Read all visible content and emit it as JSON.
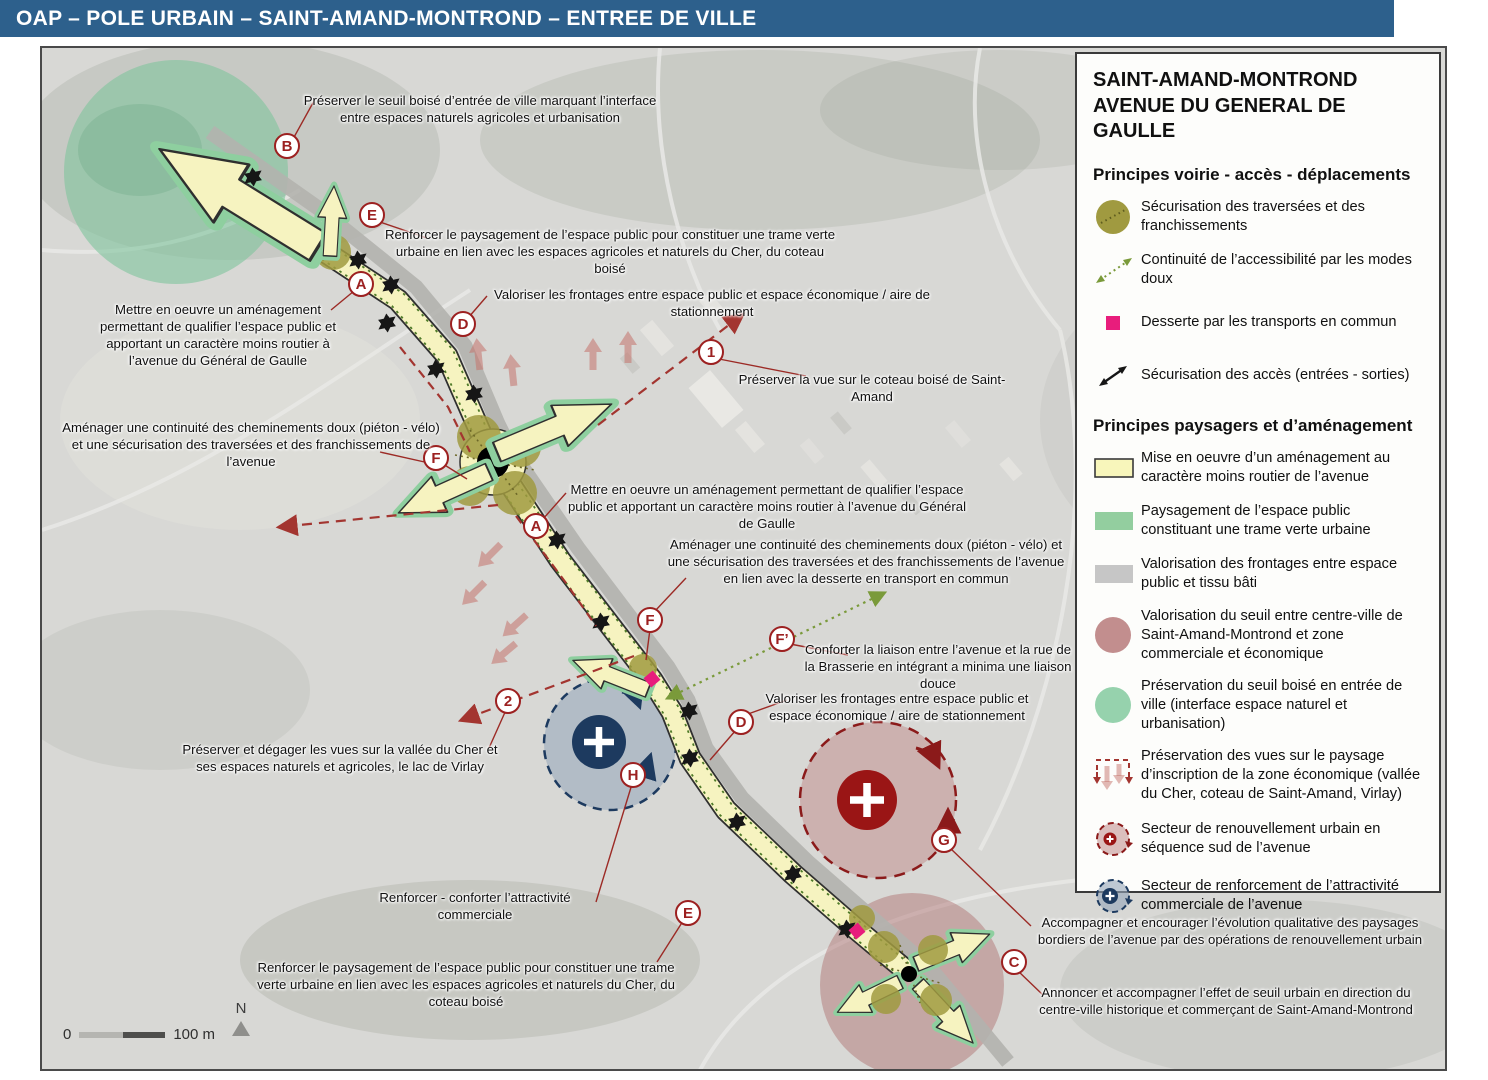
{
  "title_bar": {
    "text": "OAP – POLE URBAIN – SAINT-AMAND-MONTROND – ENTREE DE VILLE"
  },
  "legend": {
    "title_line1": "SAINT-AMAND-MONTROND",
    "title_line2": "AVENUE DU GENERAL DE GAULLE",
    "sections": [
      {
        "heading": "Principes voirie - accès - déplacements",
        "items": [
          {
            "icon": "olive-circle-dotted-icon",
            "label": "Sécurisation des traversées et des franchissements"
          },
          {
            "icon": "dotted-green-arrow-icon",
            "label": "Continuité de l’accessibilité par les modes doux"
          },
          {
            "icon": "magenta-square-icon",
            "label": "Desserte par les transports en commun"
          },
          {
            "icon": "black-double-arrow-icon",
            "label": "Sécurisation des accès (entrées - sorties)"
          }
        ]
      },
      {
        "heading": "Principes paysagers et d’aménagement",
        "items": [
          {
            "icon": "yellow-swatch-icon",
            "label": "Mise en oeuvre d’un aménagement au caractère moins routier de l’avenue"
          },
          {
            "icon": "green-swatch-icon",
            "label": "Paysagement de l’espace public constituant une trame verte urbaine"
          },
          {
            "icon": "gray-swatch-icon",
            "label": "Valorisation des frontages entre espace public et tissu bâti"
          },
          {
            "icon": "rose-circle-icon",
            "label": "Valorisation du seuil entre centre-ville de Saint-Amand-Montrond et zone commerciale et économique"
          },
          {
            "icon": "green-circle-icon",
            "label": "Préservation du seuil boisé en entrée de ville (interface espace naturel et urbanisation)"
          },
          {
            "icon": "red-dashed-views-icon",
            "label": "Préservation des vues sur le paysage d’inscription de la zone économique (vallée du Cher, coteau de Saint-Amand, Virlay)"
          },
          {
            "icon": "red-dashed-sector-icon",
            "label": "Secteur de renouvellement urbain en séquence sud de l’avenue"
          },
          {
            "icon": "blue-dashed-sector-icon",
            "label": "Secteur de renforcement de l’attractivité commerciale de l’avenue"
          }
        ]
      }
    ]
  },
  "map": {
    "markers": [
      {
        "label": "B",
        "x": 287,
        "y": 146
      },
      {
        "label": "E",
        "x": 372,
        "y": 215
      },
      {
        "label": "A",
        "x": 361,
        "y": 284
      },
      {
        "label": "D",
        "x": 463,
        "y": 324
      },
      {
        "label": "1",
        "x": 711,
        "y": 352
      },
      {
        "label": "F",
        "x": 436,
        "y": 458
      },
      {
        "label": "A",
        "x": 536,
        "y": 526
      },
      {
        "label": "F",
        "x": 650,
        "y": 620
      },
      {
        "label": "F’",
        "x": 782,
        "y": 639
      },
      {
        "label": "D",
        "x": 741,
        "y": 722
      },
      {
        "label": "2",
        "x": 508,
        "y": 701
      },
      {
        "label": "H",
        "x": 633,
        "y": 775
      },
      {
        "label": "G",
        "x": 944,
        "y": 840
      },
      {
        "label": "E",
        "x": 688,
        "y": 913
      },
      {
        "label": "C",
        "x": 1014,
        "y": 962
      }
    ],
    "annotations": [
      {
        "id": "seuil-boise-haut",
        "cx": 480,
        "y": 92,
        "w": 380,
        "text": "Préserver le seuil boisé d’entrée de ville marquant l’interface entre espaces naturels agricoles et urbanisation"
      },
      {
        "id": "paysagement-haut",
        "cx": 610,
        "y": 226,
        "w": 455,
        "text": "Renforcer le paysagement de l’espace public pour constituer une trame verte urbaine en lien avec les espaces agricoles et naturels du Cher, du coteau boisé"
      },
      {
        "id": "frontages-haut",
        "cx": 712,
        "y": 286,
        "w": 475,
        "text": "Valoriser les frontages entre espace public et espace économique / aire de stationnement"
      },
      {
        "id": "amenagement-gauche",
        "cx": 218,
        "y": 301,
        "w": 255,
        "text": "Mettre en oeuvre un aménagement permettant de qualifier l’espace public et apportant un caractère moins routier à l’avenue du Général de Gaulle"
      },
      {
        "id": "vue-coteau",
        "cx": 872,
        "y": 371,
        "w": 290,
        "text": "Préserver la vue sur le coteau boisé de Saint-Amand"
      },
      {
        "id": "cheminements-gauche",
        "cx": 251,
        "y": 419,
        "w": 385,
        "text": "Aménager une continuité des cheminements doux (piéton - vélo) et une sécurisation des traversées et des franchissements de l’avenue"
      },
      {
        "id": "amenagement-centre",
        "cx": 767,
        "y": 481,
        "w": 405,
        "text": "Mettre en oeuvre un aménagement permettant de qualifier l’espace public et apportant un caractère moins routier à l’avenue du Général de Gaulle"
      },
      {
        "id": "cheminements-centre",
        "cx": 866,
        "y": 536,
        "w": 400,
        "text": "Aménager une continuité des cheminements doux (piéton - vélo) et une sécurisation des traversées et des franchissements de l’avenue en lien avec la desserte en transport en commun"
      },
      {
        "id": "liaison-brasserie",
        "cx": 938,
        "y": 641,
        "w": 275,
        "text": "Conforter la liaison entre l’avenue et la rue de la Brasserie en intégrant a minima une liaison douce"
      },
      {
        "id": "frontages-centre",
        "cx": 897,
        "y": 690,
        "w": 295,
        "text": "Valoriser les frontages entre espace public et espace économique / aire de stationnement"
      },
      {
        "id": "vues-vallee",
        "cx": 340,
        "y": 741,
        "w": 325,
        "text": "Préserver et dégager les vues sur la vallée du Cher et ses espaces naturels et agricoles, le lac de Virlay"
      },
      {
        "id": "attractivite",
        "cx": 475,
        "y": 889,
        "w": 255,
        "text": "Renforcer - conforter l’attractivité commerciale"
      },
      {
        "id": "paysagement-bas",
        "cx": 466,
        "y": 959,
        "w": 445,
        "text": "Renforcer le paysagement de l’espace public pour constituer une trame verte urbaine en lien avec les espaces agricoles et naturels du Cher, du coteau boisé"
      },
      {
        "id": "renouvellement",
        "cx": 1230,
        "y": 914,
        "w": 400,
        "text": "Accompagner et encourager l’évolution qualitative des paysages bordiers de l’avenue par des opérations de renouvellement urbain"
      },
      {
        "id": "seuil-urbain",
        "cx": 1226,
        "y": 984,
        "w": 395,
        "text": "Annoncer et accompagner l’effet de seuil urbain en direction du centre-ville historique et commerçant de Saint-Amand-Montrond"
      }
    ],
    "scale_bar": {
      "start_label": "0",
      "end_label": "100 m"
    },
    "north_label": "N"
  },
  "colors": {
    "title_bar_bg": "#2d608c",
    "road_yellow": "#f6f3c0",
    "trame_verte_green": "#8ecf9f",
    "olive_junction": "#a09a40",
    "transport_magenta": "#e81d7c",
    "annotation_red": "#9c2020",
    "view_dash_red": "#a33530",
    "sector_renouvellement_red": "#9a1515",
    "sector_commercial_navy": "#1d3a5f",
    "seuil_rose": "#c28e8e",
    "seuil_boise_green": "#96d2ad"
  }
}
